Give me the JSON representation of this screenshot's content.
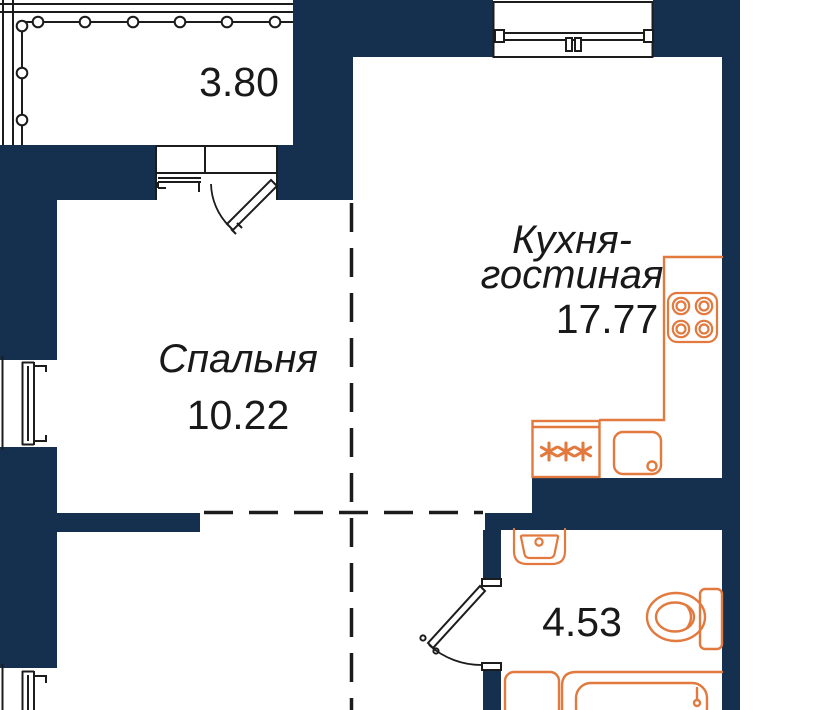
{
  "colors": {
    "wall": "#14304E",
    "fixture": "#E2793F",
    "line": "#1C1C1C",
    "text": "#191919",
    "bg": "#FFFFFF"
  },
  "rooms": {
    "balcony": {
      "area": "3.80"
    },
    "kitchen_living": {
      "name_line1": "Кухня-",
      "name_line2": "гостиная",
      "area": "17.77"
    },
    "bedroom": {
      "name": "Спальня",
      "area": "10.22"
    },
    "bathroom": {
      "area": "4.53"
    }
  },
  "fixtures": [
    "balcony-railing",
    "balcony-door",
    "kitchen-window",
    "bedroom-window",
    "hall-window",
    "kitchen-counter",
    "stove",
    "fridge",
    "kitchen-sink",
    "bathroom-door",
    "bathroom-sink",
    "toilet",
    "bathtub",
    "washing-machine"
  ]
}
